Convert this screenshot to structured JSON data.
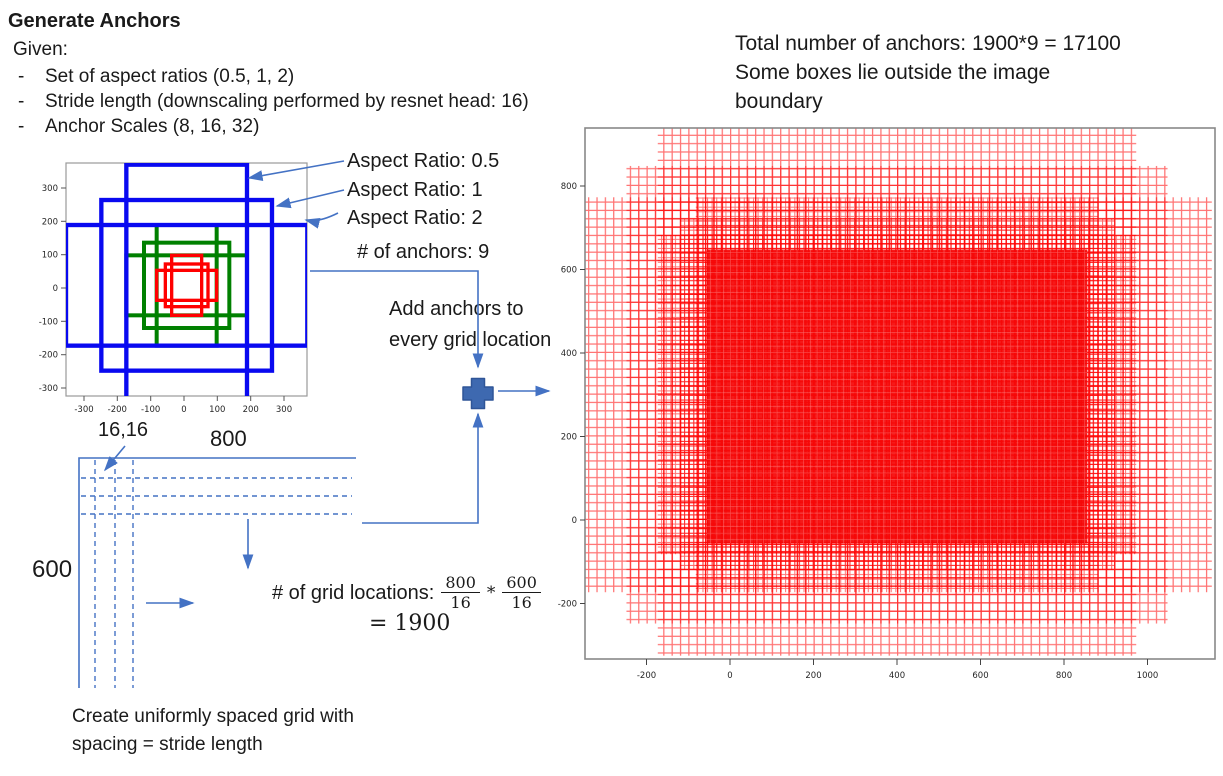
{
  "slide": {
    "title": "Generate Anchors",
    "given_label": "Given:",
    "dash": "-",
    "bullets": [
      "Set of aspect ratios (0.5, 1, 2)",
      "Stride length (downscaling performed by resnet head: 16)",
      "Anchor Scales (8, 16, 32)"
    ],
    "aspect_labels": [
      "Aspect Ratio: 0.5",
      "Aspect Ratio: 1",
      "Aspect Ratio: 2"
    ],
    "num_anchors": "# of anchors: 9",
    "add_anchors_line1": "Add anchors to",
    "add_anchors_line2": "every grid location",
    "grid_width_label": "800",
    "grid_height_label": "600",
    "grid_origin_label": "16,16",
    "grid_loc_label": "# of grid locations:",
    "frac1": {
      "num": "800",
      "den": "16"
    },
    "frac_op": "*",
    "frac2": {
      "num": "600",
      "den": "16"
    },
    "grid_loc_result": "= 1900",
    "bottom_line1": "Create uniformly spaced grid with",
    "bottom_line2": "spacing = stride length",
    "total_line1": "Total number of anchors: 1900*9 = 17100",
    "total_line2": "Some boxes lie outside the image",
    "total_line3": "boundary"
  },
  "colors": {
    "connector": "#4472C4",
    "plus_fill": "#3E69B0",
    "anchor_red": "#FF0000",
    "anchor_green": "#008000",
    "anchor_blue": "#0909F0",
    "grid_red": "#FF0000",
    "frame_gray": "#888888"
  },
  "chart_data": [
    {
      "name": "anchor-boxes-plot",
      "type": "scatter",
      "title": "",
      "xlabel": "",
      "ylabel": "",
      "xlim": [
        -354,
        369
      ],
      "ylim": [
        -324,
        375
      ],
      "xticks": [
        -300,
        -200,
        -100,
        0,
        100,
        200,
        300
      ],
      "yticks": [
        300,
        200,
        100,
        0,
        -100,
        -200,
        -300
      ],
      "anchor_center": [
        8,
        8
      ],
      "series": [
        {
          "name": "scale 8 (red)",
          "color": "#FF0000",
          "box_sizes_wh": [
            [
              90,
              181
            ],
            [
              128,
              128
            ],
            [
              181,
              90
            ]
          ]
        },
        {
          "name": "scale 16 (green)",
          "color": "#008000",
          "box_sizes_wh": [
            [
              181,
              362
            ],
            [
              256,
              256
            ],
            [
              362,
              181
            ]
          ]
        },
        {
          "name": "scale 32 (blue)",
          "color": "#0909F0",
          "box_sizes_wh": [
            [
              362,
              724
            ],
            [
              512,
              512
            ],
            [
              724,
              362
            ]
          ]
        }
      ]
    },
    {
      "name": "all-anchors-plot",
      "type": "heatmap",
      "title": "",
      "xlabel": "",
      "ylabel": "",
      "xlim": [
        -347,
        1162
      ],
      "ylim": [
        -333,
        939
      ],
      "xticks": [
        -200,
        0,
        200,
        400,
        600,
        800,
        1000
      ],
      "yticks": [
        800,
        600,
        400,
        200,
        0,
        -200
      ],
      "image_size": [
        800,
        600
      ],
      "stride": 16,
      "anchors_per_location": 9,
      "grid_locations": 1900,
      "total_anchors": 17100
    }
  ]
}
